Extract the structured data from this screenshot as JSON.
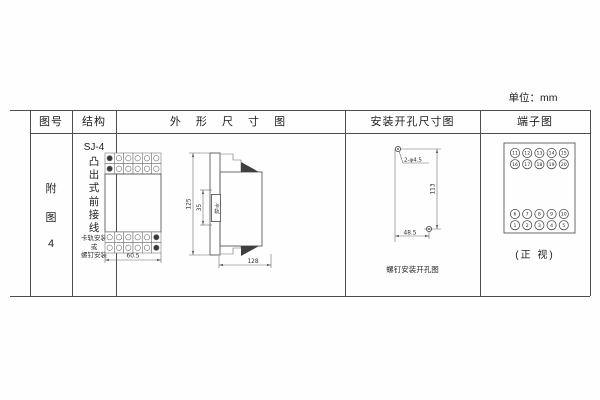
{
  "unit_label": "单位：mm",
  "table": {
    "headers": [
      "图号",
      "结构",
      "外 形 尺 寸 图",
      "安装开孔尺寸图",
      "端子图"
    ]
  },
  "figure_no": {
    "chars": [
      "附",
      "图",
      "4"
    ]
  },
  "structure": {
    "model": "SJ-4",
    "type_chars": [
      "凸",
      "出",
      "式",
      "前",
      "接",
      "线"
    ],
    "mount_note": [
      "卡轨安装",
      "或",
      "螺钉安装"
    ]
  },
  "outline": {
    "front_width": "60.5",
    "height": "125",
    "rail_span": "35",
    "rail_label": "卡轨",
    "depth": "128",
    "front_terminals": {
      "cols": 6,
      "rows": 2
    }
  },
  "mounting": {
    "hole_label": "2-φ4.5",
    "vertical_dim": "113",
    "horizontal_dim": "48.5",
    "caption": "螺钉安装开孔图"
  },
  "terminal": {
    "rows_top": [
      [
        "11",
        "12",
        "13",
        "14",
        "15"
      ],
      [
        "16",
        "17",
        "18",
        "19",
        "20"
      ]
    ],
    "rows_bottom": [
      [
        "6",
        "7",
        "8",
        "9",
        "10"
      ],
      [
        "1",
        "2",
        "3",
        "4",
        "5"
      ]
    ],
    "caption": "(正 视)"
  }
}
